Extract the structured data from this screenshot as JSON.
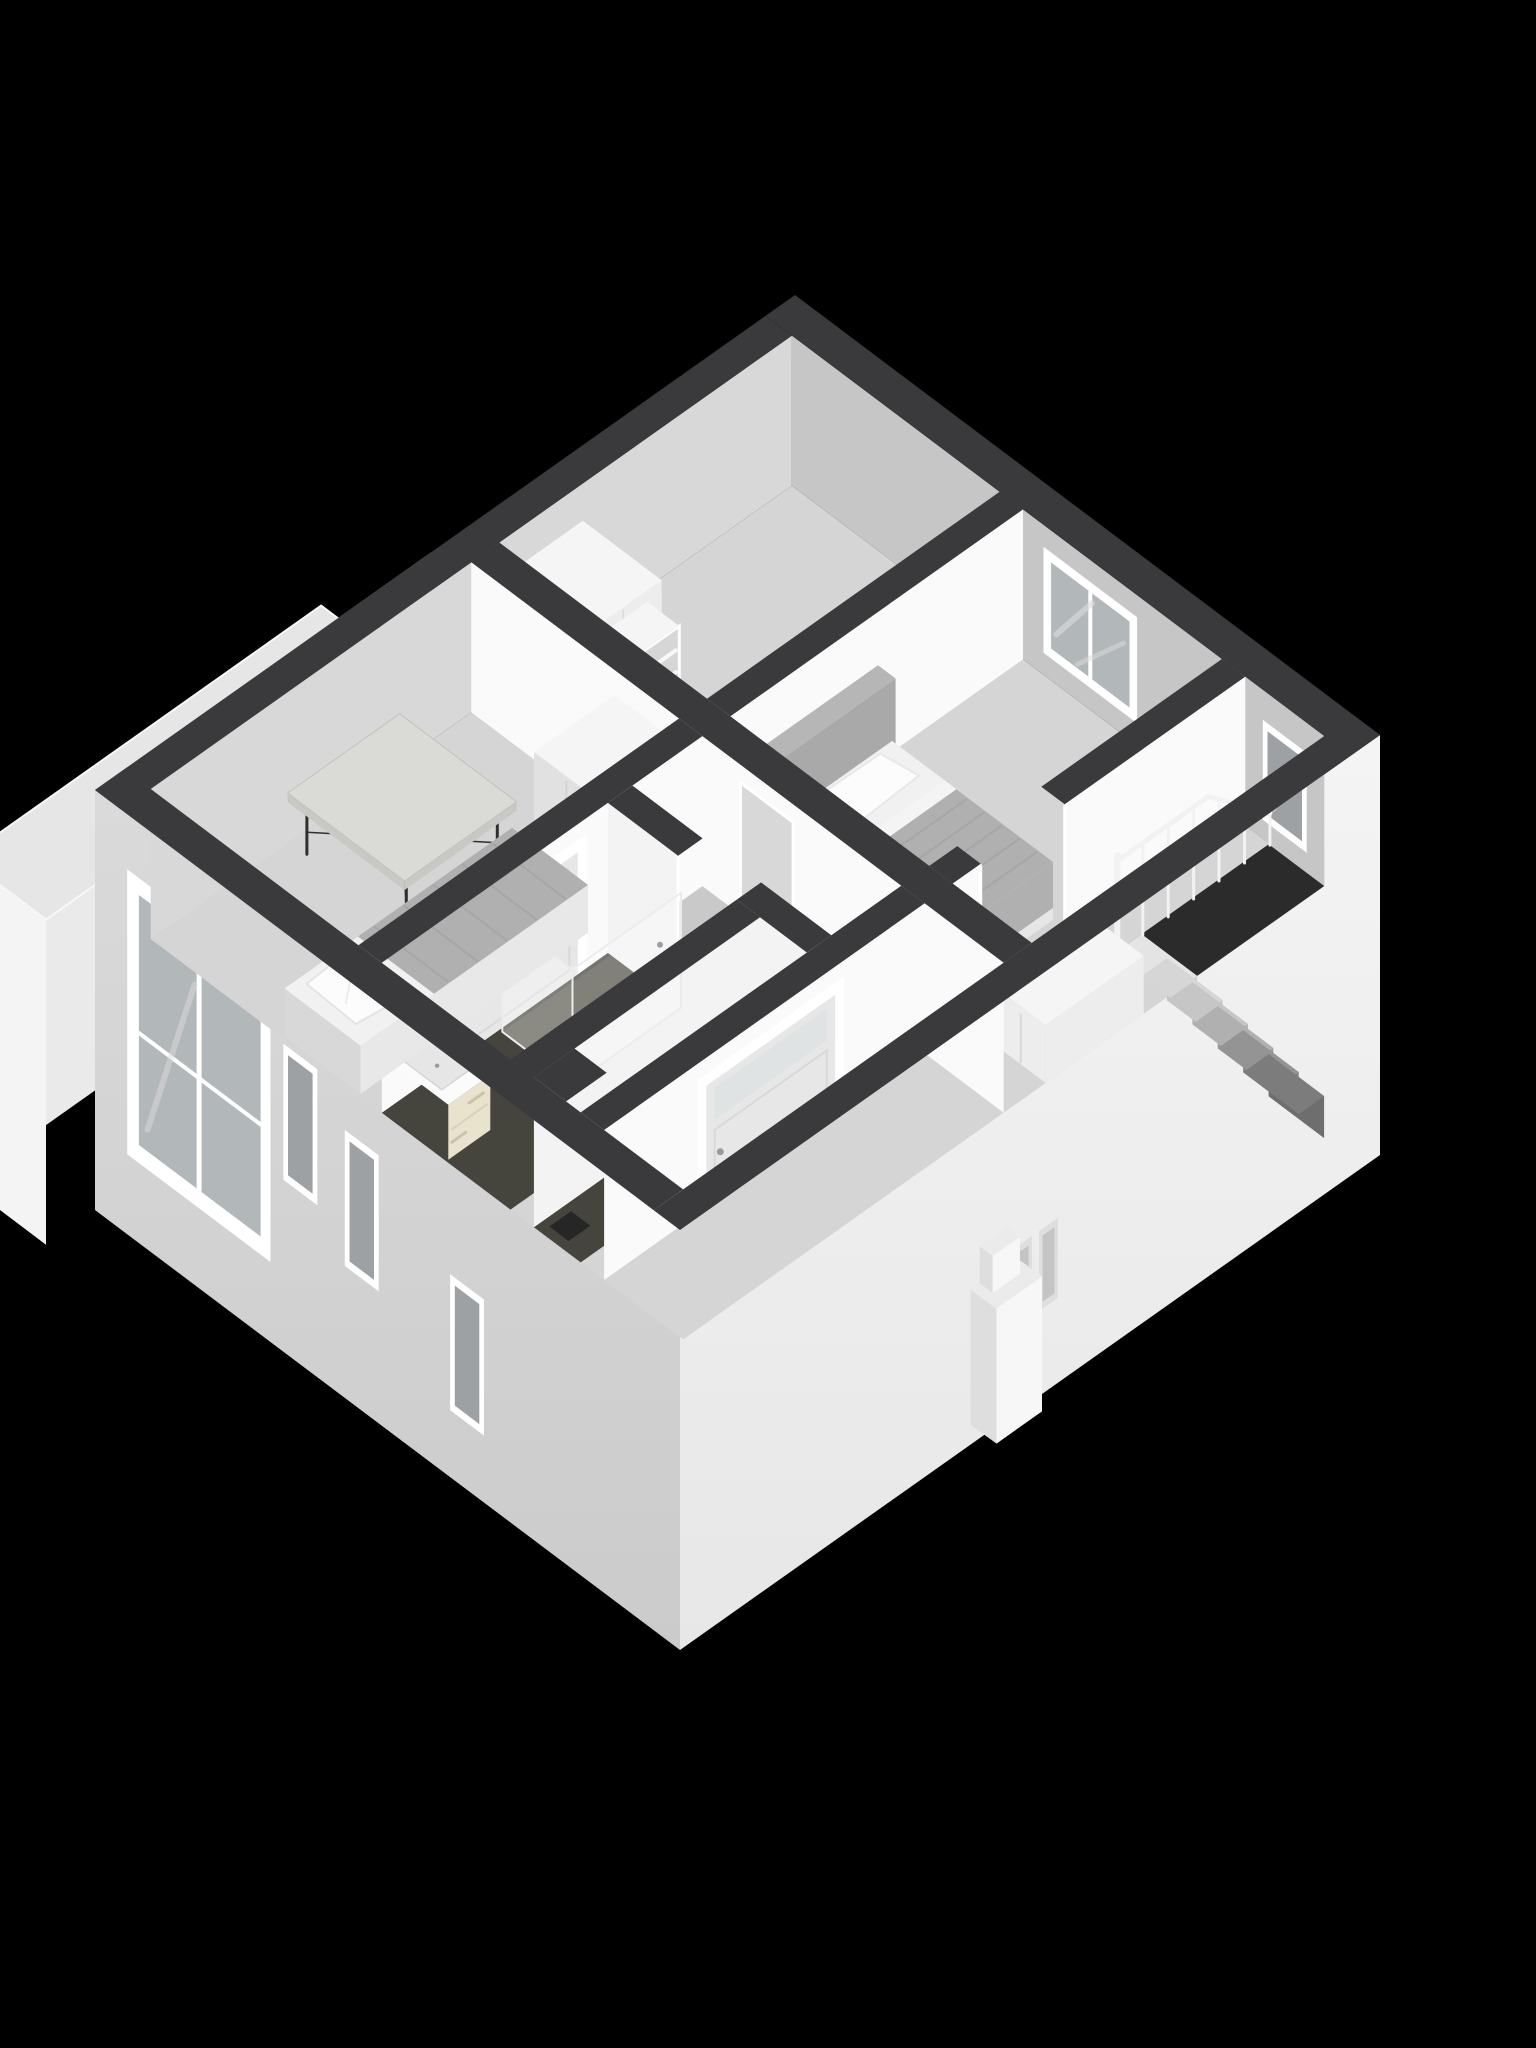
{
  "meta": {
    "type": "3d-floorplan-cutaway-render",
    "view": "isometric",
    "background": "#000000"
  },
  "colors": {
    "background": "#000000",
    "cutTop": "#3a3a3c",
    "wallBright": "#fafafa",
    "wallLight": "#f3f3f3",
    "wallNeInner": "#c6c6c6",
    "wallNwInner": "#d8d8d8",
    "floorBase": "#d5d5d5",
    "floorHall": "#c9c9c9",
    "floorBath": "#45443d",
    "floorShower": "#55544b",
    "stairwell": "#2b2b2b",
    "extSw": "#cbcbcb",
    "extSwTop": "#dadada",
    "extSe": "#f0f0f0",
    "extNw": "#c2c2c2",
    "annexRoof": "#e6e6e6",
    "annexWallSw": "#f4f4f4",
    "annexWallW": "#eaeaea",
    "frameWhite": "#ffffff",
    "glass": "#b2b7b9",
    "glassDark": "#9da1a3",
    "glassStripe": "#dcdcdc",
    "glassPane": "rgba(255,255,255,0.32)",
    "doorLeaf": "#e7e7e7",
    "transom": "#dfe3e4",
    "handle": "#9a9a9a",
    "mattress": "#f1f1f1",
    "blanket": "#b0b0b0",
    "blanketStripe": "#a2a2a2",
    "pillow": "#fcfcfc",
    "headboardSe": "#a9a9a9",
    "headboardTop": "#b6b6b6",
    "headboardSw": "#9b9b9b",
    "bedFrameSe": "#e6e6e6",
    "bedFrameSw": "#d8d8d8",
    "deskTop": "#dadad6",
    "deskEdge": "#c8c8c4",
    "deskLeg": "#2f2f2f",
    "boxTop": "#f5f5f5",
    "boxSe": "#ededed",
    "boxSw": "#e1e1e1",
    "shelfInner": "#d6d6d6",
    "shelfLine": "#f8f8f8",
    "vanityFront": "#e9e2cd",
    "vanityDrawer": "#d8d2bd",
    "vanityTop": "#fbfbfb",
    "basin": "#e6e6e6",
    "rail": "#f2f2f2",
    "tick": "#d2d2d2",
    "chimneyFront": "#f7f7f7",
    "chimneySide": "#dedede",
    "chimneyTop": "#ebebeb",
    "slotOuter": "#dedede",
    "slotInner": "#c4c4c4",
    "treads": [
      "#e4e4e4",
      "#d6d6d6",
      "#c6c6c6",
      "#b0b0b0",
      "#949494",
      "#7c7c7c"
    ],
    "risers": [
      "#d2d2d2",
      "#c4c4c4",
      "#b2b2b2",
      "#9c9c9c",
      "#848484",
      "#6e6e6e"
    ]
  },
  "scene": {
    "exterior": [
      "front-wall-with-windows",
      "side-wall",
      "flat-roof-annex",
      "chimney-protrusion"
    ],
    "rooms": [
      {
        "name": "bedroom-rear",
        "furniture": [
          "single-bed",
          "pillow",
          "blanket",
          "window"
        ]
      },
      {
        "name": "stair-landing",
        "furniture": [
          "staircase",
          "stair-railing",
          "dresser",
          "window"
        ]
      },
      {
        "name": "storage-room",
        "furniture": [
          "wardrobe",
          "bookshelf"
        ]
      },
      {
        "name": "bedroom-front",
        "furniture": [
          "desk",
          "single-bed",
          "wardrobe",
          "window"
        ]
      },
      {
        "name": "bathroom",
        "furniture": [
          "sink-vanity",
          "faucet",
          "shower-enclosure"
        ]
      },
      {
        "name": "hallway",
        "furniture": [
          "door-with-transom",
          "door-with-transom",
          "doorway",
          "service-shaft"
        ]
      }
    ]
  }
}
